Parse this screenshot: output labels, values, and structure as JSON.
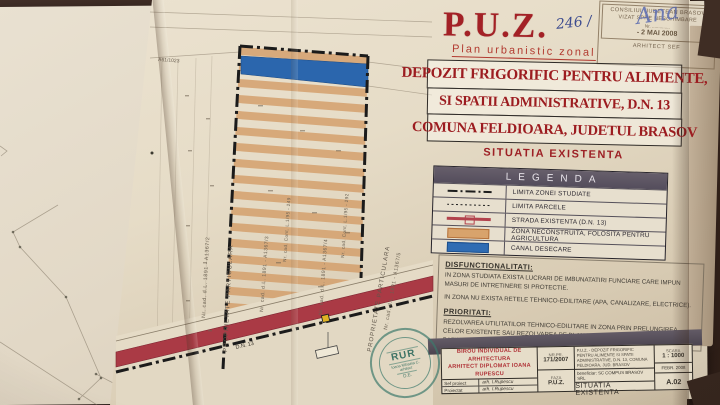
{
  "header": {
    "puz": "P.U.Z.",
    "puz_subtitle": "Plan urbanistic zonal",
    "handwritten_nr": "246 /",
    "approval_stamp": {
      "line1": "CONSILIUL JUDETEAN BRASOV",
      "line2": "VIZAT SPRE NESCHIMBARE",
      "nr_label": "Nr. ..............",
      "date": "- 2 MAI 2008",
      "role": "ARHITECT SEF",
      "signature": "Ana"
    }
  },
  "project": {
    "title_line1": "DEPOZIT FRIGORIFIC PENTRU ALIMENTE,",
    "title_line2": "SI SPATII ADMINISTRATIVE, D.N. 13",
    "title_line3": "COMUNA FELDIOARA, JUDETUL BRASOV",
    "phase_title": "SITUATIA EXISTENTA"
  },
  "legend": {
    "title": "LEGENDA",
    "items": [
      {
        "label": "LIMITA ZONEI STUDIATE"
      },
      {
        "label": "LIMITA PARCELE"
      },
      {
        "label": "STRADA EXISTENTA  (D.N. 13)"
      },
      {
        "label": "ZONA NECONSTRUITA, FOLOSITA PENTRU AGRICULTURA"
      },
      {
        "label": "CANAL DESECARE"
      }
    ]
  },
  "notes": {
    "disfunctionalitati_title": "DISFUNCTIONALITATI:",
    "disfunctionalitati_1": "IN ZONA STUDIATA EXISTA LUCRARI DE IMBUNATATIRI FUNCIARE CARE IMPUN MASURI DE INTRETINERE SI PROTECTIE.",
    "disfunctionalitati_2": "IN ZONA NU EXISTA RETELE TEHNICO-EDILITARE  (APA, CANALIZARE, ELECTRICE).",
    "prioritati_title": "PRIORITATI:",
    "prioritati_1": "REZOLVAREA UTILITATILOR TEHNICO-EDILITARE IN ZONA PRIN PRELUNGIREA CELOR EXISTENTE SAU REZOLVAREA PE PLAN LOCAL (PUT FORAT PENTRU APA SI BAZIN VIDANJABIL PENTRU APELE UZATE MENAJERE)."
  },
  "map": {
    "parcel_ref": "A61/1023",
    "left_owner": "PROPRIETATE PARTICULARA",
    "left_cad": "Nr. cad. d.L. 1891 - A1367/2",
    "inner_cad_1": "Nr. cad. d.L. 1891 - A1367/3",
    "inner_cad_2": "Nr. cad. Cont. L.1/95 - 249",
    "inner_cad_3": "Nr. cad. d.L. 1891 - A1367/4",
    "inner_cad_4": "Nr. cad. Cont. L.1/95 - 292",
    "right_owner": "PROPRIETATE PARTICULARA",
    "right_cad": "Nr. cad. d.L. 1891 - A1367/5",
    "road_label": "D.N. 13"
  },
  "cartouche": {
    "firm_line1": "BIROU INDIVIDUAL DE ARHITECTURA",
    "firm_line2": "ARHITECT DIPLOMAT IOANA RUPESCU",
    "row1_role": "Sef proiect",
    "row1_name": "arh. I.Rupescu",
    "row2_role": "Proiectat",
    "row2_name": "arh. I.Rupescu",
    "nr_label": "NR.PR.",
    "nr_value": "171/2007",
    "faza_label": "FAZA",
    "faza_value": "P.U.Z.",
    "project_title": "P.U.Z. - DEPOZIT FRIGORIFIC PENTRU ALIMENTE SI SPATII ADMINISTRATIVE, D.N. 13, COMUNA FELDIOARA, JUD. BRASOV",
    "beneficiar": "beneficiar:  SC COMPUS BRASOV SRL",
    "scara_label": "SCARA",
    "scara_value": "1 : 1000",
    "data_value": "FEBR. 2008",
    "plansa_title": "SITUATIA EXISTENTA",
    "plansa_nr": "A.02"
  },
  "rur_stamp": {
    "acronym": "RUR",
    "name": "Ioana Mihaela C.",
    "role": "arhitect",
    "initials": "D.E."
  },
  "palette": {
    "title_red": "#9c1c20",
    "agriculture": "#d49e6a",
    "canal_blue": "#2b66ad",
    "road_red": "#aa3a45",
    "legend_header": "#544d5c"
  }
}
